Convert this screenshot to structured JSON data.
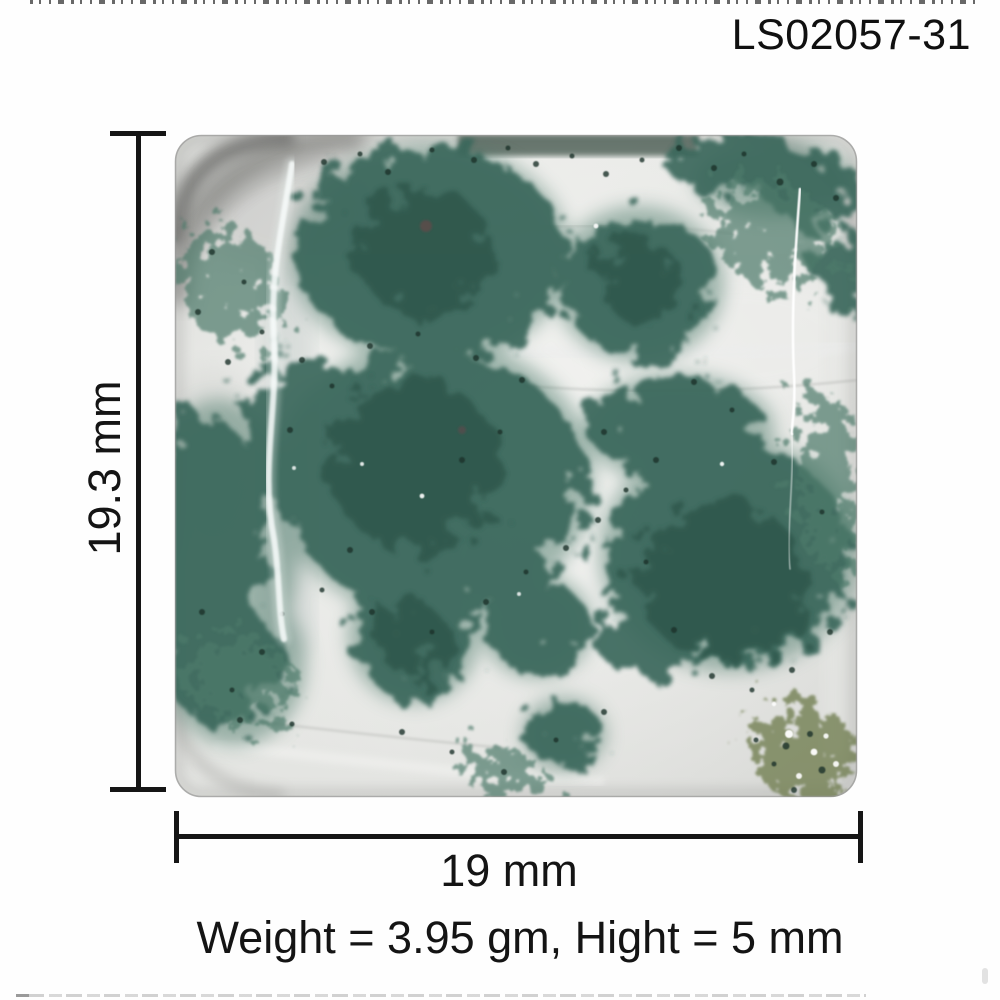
{
  "header": {
    "product_code": "LS02057-31"
  },
  "stone": {
    "description": "green moss agate square cabochon gemstone, translucent white with dark green moss inclusions"
  },
  "annotations": {
    "height_label": "19.3 mm",
    "width_label": "19 mm",
    "caption": "Weight = 3.95 gm, Hight = 5 mm"
  },
  "colors": {
    "annotation_ink": "#151515",
    "moss_green": "#3a685c",
    "moss_green_dark": "#2d564b",
    "moss_green_light": "#4e7a6a",
    "speckle_dark": "#1d332a",
    "olive_druzy": "#6f7d4f",
    "stone_body": "#e6e7e4",
    "stone_shadow": "#c9cac7",
    "background": "#ffffff"
  }
}
